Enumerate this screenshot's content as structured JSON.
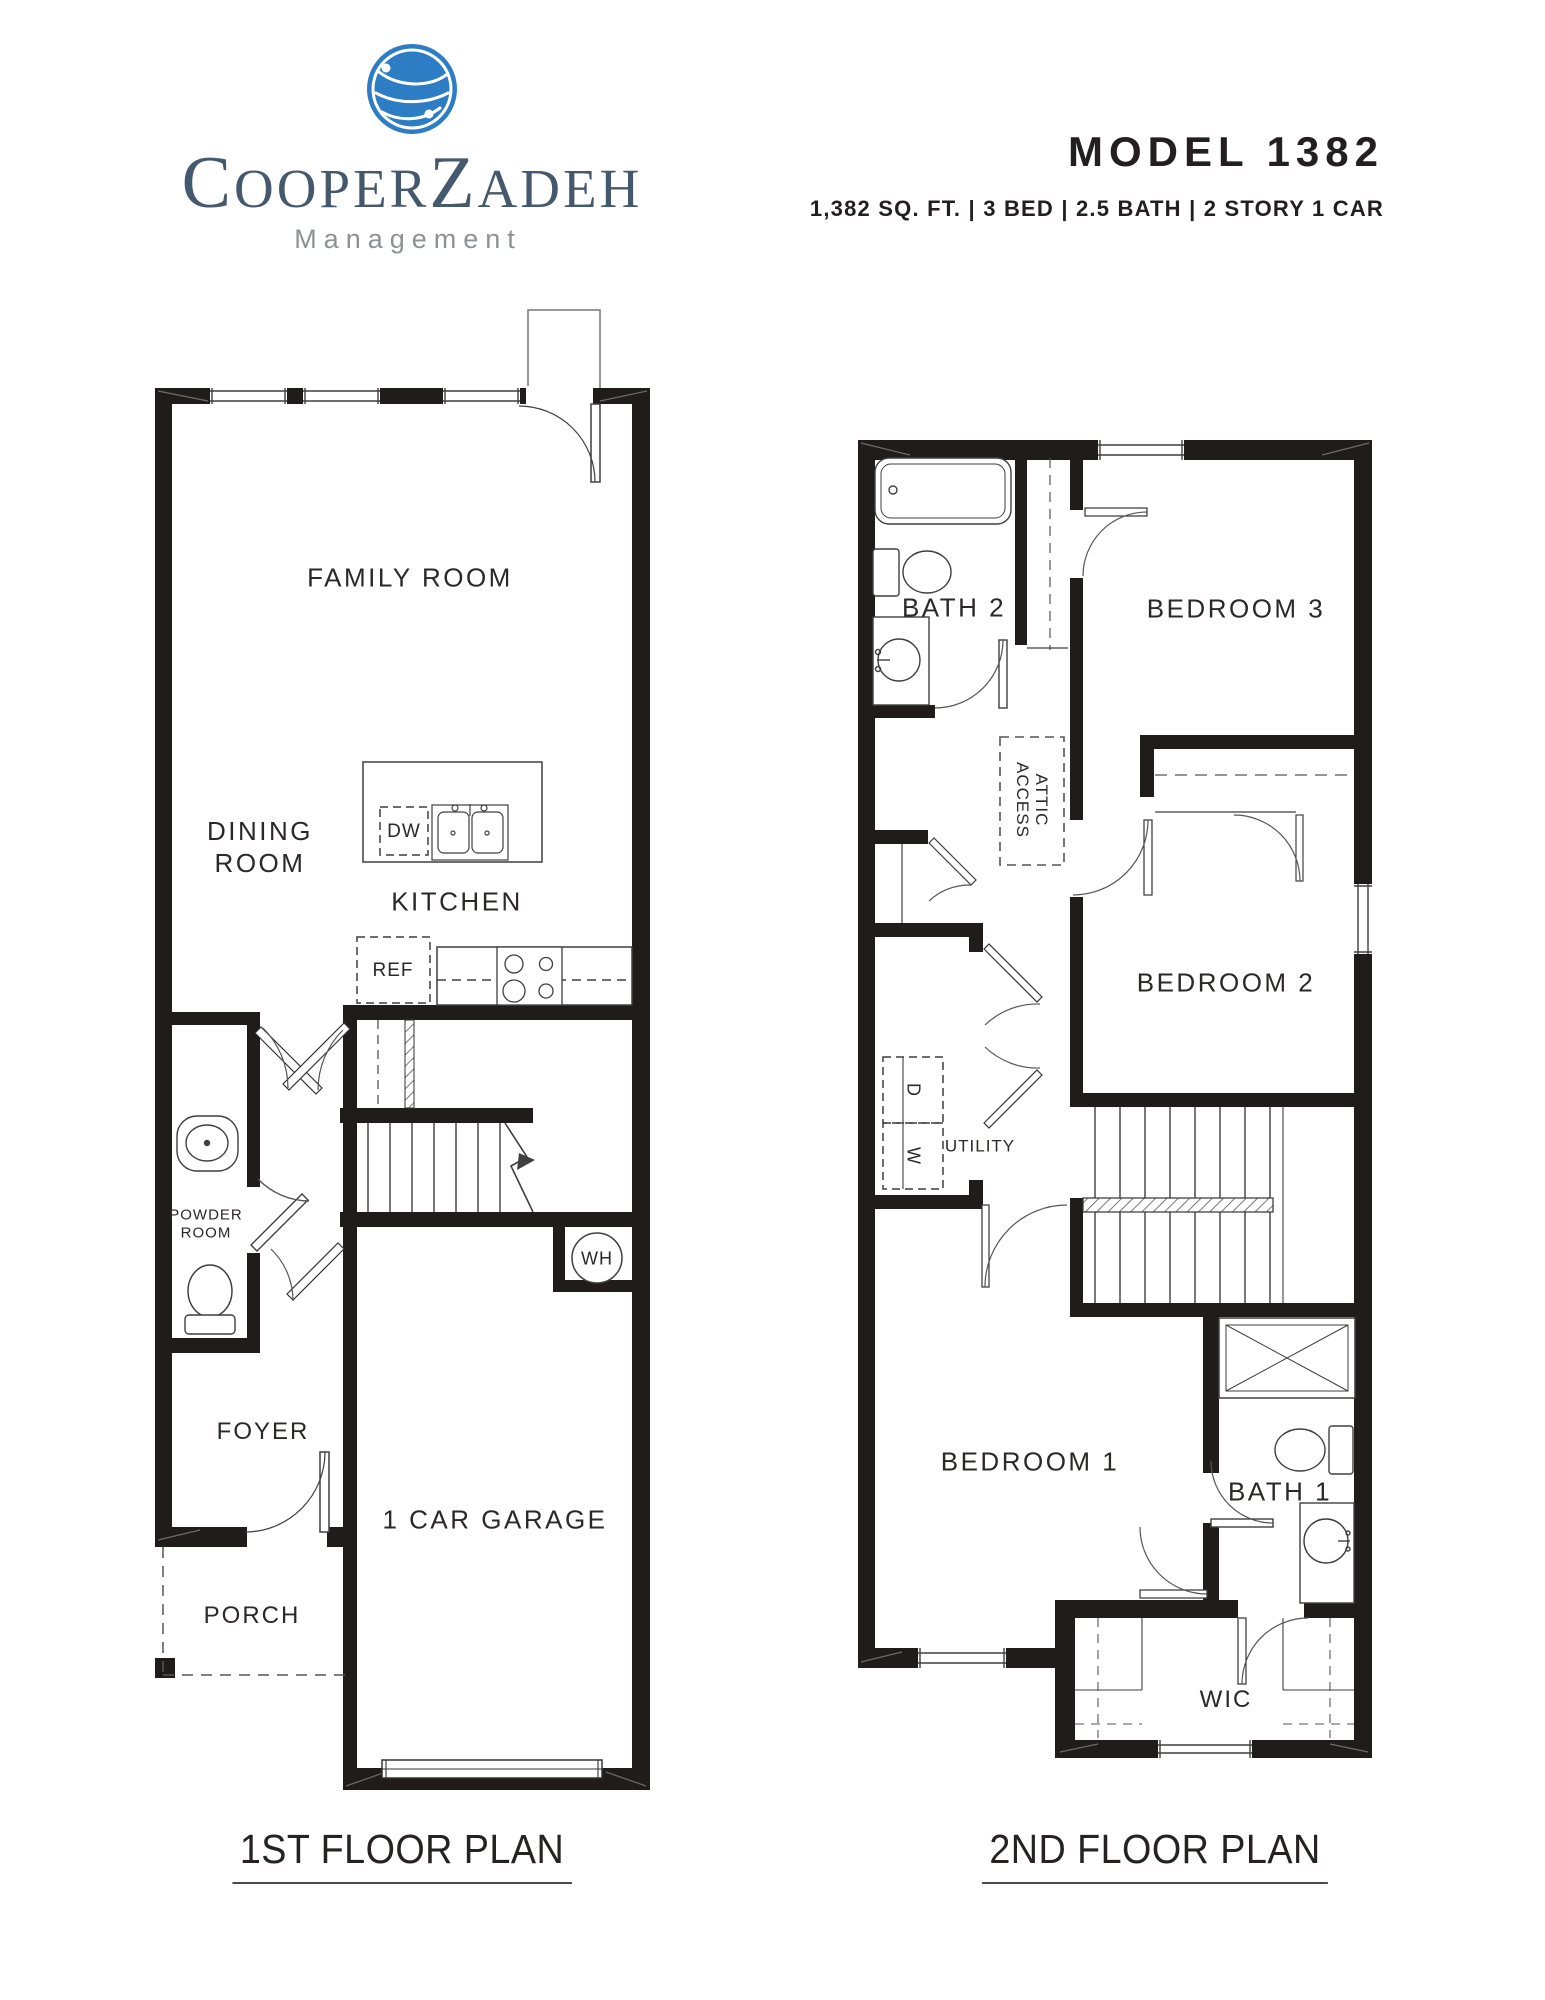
{
  "brand": {
    "word_c": "C",
    "word_ooper": "OOPER",
    "word_z": "Z",
    "word_adeh": "ADEH",
    "subtitle": "Management"
  },
  "model": {
    "title": "MODEL 1382",
    "specs_value": "1,382",
    "specs_rest": " SQ. FT. | 3 BED | 2.5 BATH | 2 STORY 1 CAR"
  },
  "floor1": {
    "caption": "1ST FLOOR PLAN",
    "labels": {
      "family_room": "FAMILY ROOM",
      "dining_line1": "DINING",
      "dining_line2": "ROOM",
      "kitchen": "KITCHEN",
      "dishwasher": "DW",
      "refrigerator": "REF",
      "water_heater": "WH",
      "powder_line1": "POWDER",
      "powder_line2": "ROOM",
      "foyer": "FOYER",
      "garage": "1 CAR GARAGE",
      "porch": "PORCH"
    }
  },
  "floor2": {
    "caption": "2ND FLOOR PLAN",
    "labels": {
      "bath2": "BATH 2",
      "bedroom3": "BEDROOM 3",
      "attic_line1": "ATTIC",
      "attic_line2": "ACCESS",
      "bedroom2": "BEDROOM 2",
      "utility": "UTILITY",
      "dryer": "D",
      "washer": "W",
      "bedroom1": "BEDROOM 1",
      "bath1": "BATH 1",
      "wic": "WIC"
    }
  },
  "colors": {
    "wall": "#201c1b",
    "line": "#3f3f3f",
    "logo_blue": "#2d7dc5",
    "logo_navy": "#44586e",
    "management_gray": "#8e9194",
    "ink": "#231f20"
  }
}
